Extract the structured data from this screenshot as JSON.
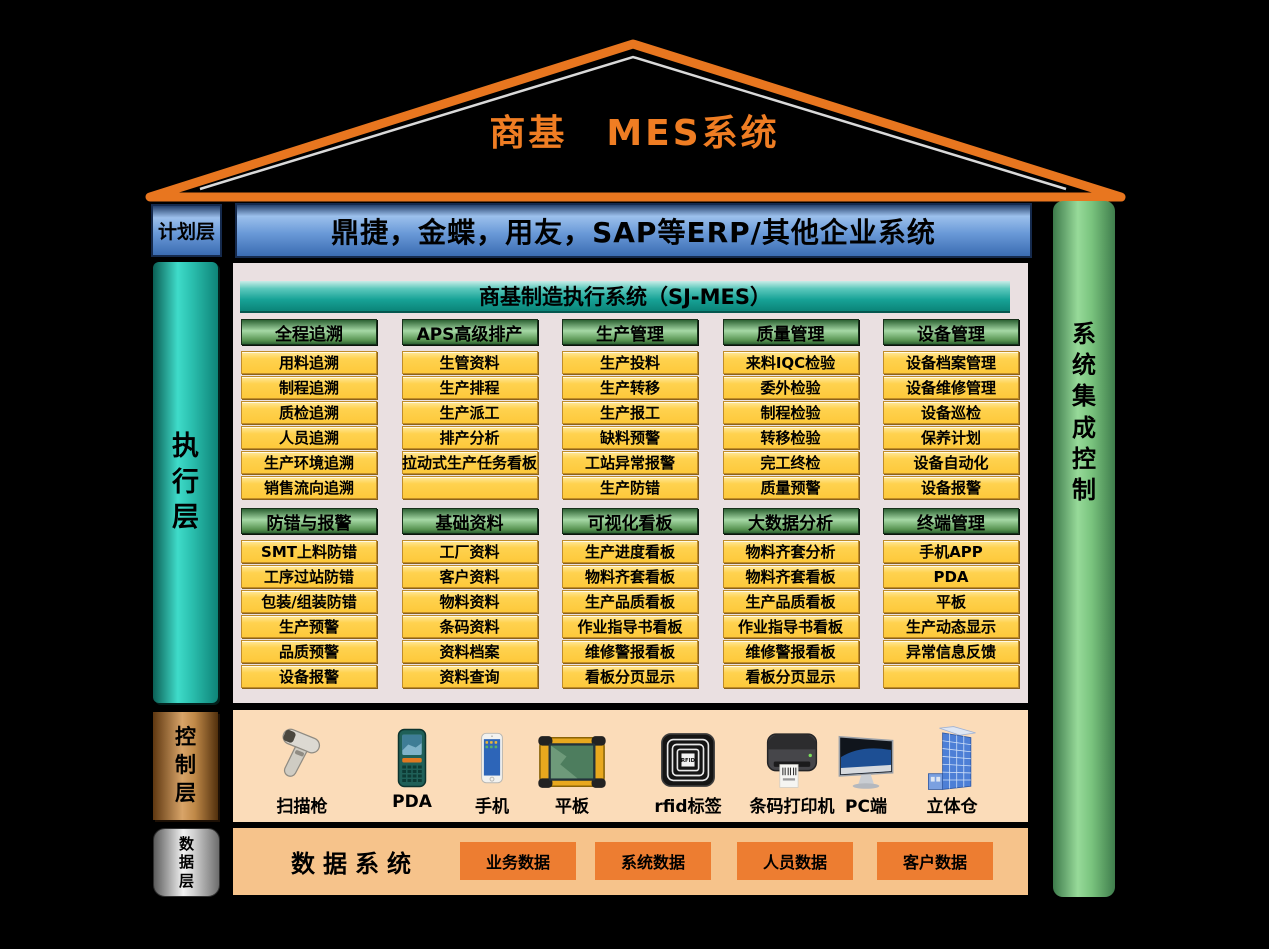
{
  "title": {
    "text": "商基　MES系统"
  },
  "planning": {
    "label": "计划层",
    "content": "鼎捷，金蝶，用友，SAP等ERP/其他企业系统"
  },
  "execution": {
    "label": "执行层",
    "banner": "商基制造执行系统（SJ-MES）",
    "rows": [
      [
        {
          "header": "全程追溯",
          "items": [
            "用料追溯",
            "制程追溯",
            "质检追溯",
            "人员追溯",
            "生产环境追溯",
            "销售流向追溯"
          ]
        },
        {
          "header": "APS高级排产",
          "items": [
            "生管资料",
            "生产排程",
            "生产派工",
            "排产分析",
            "拉动式生产任务看板",
            ""
          ]
        },
        {
          "header": "生产管理",
          "items": [
            "生产投料",
            "生产转移",
            "生产报工",
            "缺料预警",
            "工站异常报警",
            "生产防错"
          ]
        },
        {
          "header": "质量管理",
          "items": [
            "来料IQC检验",
            "委外检验",
            "制程检验",
            "转移检验",
            "完工终检",
            "质量预警"
          ]
        },
        {
          "header": "设备管理",
          "items": [
            "设备档案管理",
            "设备维修管理",
            "设备巡检",
            "保养计划",
            "设备自动化",
            "设备报警"
          ]
        }
      ],
      [
        {
          "header": "防错与报警",
          "items": [
            "SMT上料防错",
            "工序过站防错",
            "包装/组装防错",
            "生产预警",
            "品质预警",
            "设备报警"
          ]
        },
        {
          "header": "基础资料",
          "items": [
            "工厂资料",
            "客户资料",
            "物料资料",
            "条码资料",
            "资料档案",
            "资料查询"
          ]
        },
        {
          "header": "可视化看板",
          "items": [
            "生产进度看板",
            "物料齐套看板",
            "生产品质看板",
            "作业指导书看板",
            "维修警报看板",
            "看板分页显示"
          ]
        },
        {
          "header": "大数据分析",
          "items": [
            "物料齐套分析",
            "物料齐套看板",
            "生产品质看板",
            "作业指导书看板",
            "维修警报看板",
            "看板分页显示"
          ]
        },
        {
          "header": "终端管理",
          "items": [
            "手机APP",
            "PDA",
            "平板",
            "生产动态显示",
            "异常信息反馈",
            ""
          ]
        }
      ]
    ]
  },
  "integration": {
    "label": "系统集成控制"
  },
  "control": {
    "label": "控制层",
    "devices": [
      {
        "icon": "scanner-gun-icon",
        "label": "扫描枪"
      },
      {
        "icon": "pda-icon",
        "label": "PDA"
      },
      {
        "icon": "smartphone-icon",
        "label": "手机"
      },
      {
        "icon": "tablet-icon",
        "label": "平板"
      },
      {
        "icon": "rfid-tag-icon",
        "label": "rfid标签"
      },
      {
        "icon": "barcode-printer-icon",
        "label": "条码打印机"
      },
      {
        "icon": "pc-monitor-icon",
        "label": "PC端"
      },
      {
        "icon": "warehouse-icon",
        "label": "立体仓"
      }
    ]
  },
  "dataLayer": {
    "label": "数据层",
    "title": "数据系统",
    "boxes": [
      "业务数据",
      "系统数据",
      "人员数据",
      "客户数据"
    ]
  },
  "colors": {
    "roof_orange": "#E8761F",
    "title_orange": "#EF7D23",
    "plan_blue": "#4472C4",
    "banner_teal": "#17A296",
    "header_green": "#6FBF73",
    "cell_yellow": "#FFD24F",
    "panel_gray": "#EAE0E1",
    "control_peach": "#FBDCB9",
    "data_panel_orange": "#F6C38B",
    "data_box_orange": "#ED7D31",
    "integration_green": "#7CC87F",
    "exec_teal": "#2CC2B1",
    "control_copper": "#C08948",
    "data_silver": "#CFCFCF"
  }
}
